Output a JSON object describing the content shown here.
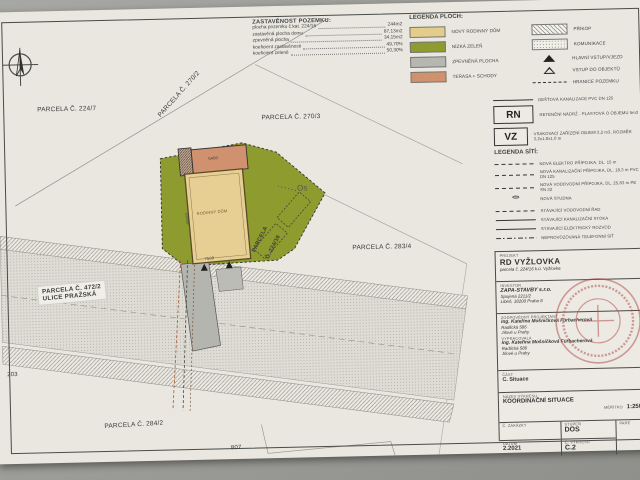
{
  "site_stats": {
    "title": "ZASTAVĚNOST POZEMKU:",
    "rows": [
      {
        "label": "plocha pozemku č.kat. 224/16",
        "value": "244m2"
      },
      {
        "label": "zastavěná plocha domu",
        "value": "87,13m2"
      },
      {
        "label": "zpevněná plocha",
        "value": "34,15m2"
      },
      {
        "label": "koeficient zastavěnosti",
        "value": "49,70%"
      },
      {
        "label": "koeficient zeleně",
        "value": "50,30%"
      }
    ]
  },
  "legend_ploch": {
    "title": "LEGENDA PLOCH:",
    "color_items": [
      {
        "label": "NOVÝ RODINNÝ DŮM",
        "color": "#e4cd8b"
      },
      {
        "label": "NÍZKÁ ZELEŇ",
        "color": "#8d9b2f"
      },
      {
        "label": "ZPEVNĚNÁ PLOCHA",
        "color": "#b7b7b2"
      },
      {
        "label": "TERASA + SCHODY",
        "color": "#d0916f"
      }
    ],
    "pattern_items": [
      {
        "label": "PŘÍKOP"
      },
      {
        "label": "KOMUNIKACE"
      },
      {
        "label": "HLAVNÍ VSTUP/VJEZD"
      },
      {
        "label": "VSTUP DO OBJEKTŮ"
      },
      {
        "label": "HRANICE POZEMKU"
      }
    ]
  },
  "legend_site": {
    "rain_label": "DEŠŤOVÁ KANALIZACE PVC DN 125",
    "rn_code": "RN",
    "rn_label": "RETENČNÍ NÁDRŽ - PLASTOVÁ O OBJEMU 5m3",
    "vz_code": "VZ",
    "vz_label": "VSAKOVACÍ ZAŘÍZENÍ OBJEM 3,2 m3, ROZMĚR 3,2x1,8x1,0 m",
    "title": "LEGENDA SÍTÍ:",
    "items": [
      {
        "label": "NOVÁ ELEKTRO PŘÍPOJKA, DL. 15 m"
      },
      {
        "label": "NOVÁ KANALIZAČNÍ PŘÍPOJKA, DL. 18,3 m PVC DN 125"
      },
      {
        "label": "NOVÁ VODOVODNÍ PŘÍPOJKA, DL. 25,83 m PE SN 32"
      },
      {
        "label": "NOVÁ STUDNA"
      },
      {
        "label": "STÁVAJÍCÍ VODOVODNÍ ŘAD"
      },
      {
        "label": "STÁVAJÍCÍ KANALIZAČNÍ STOKA"
      },
      {
        "label": "STÁVAJÍCÍ ELEKTRICKÝ ROZVOD"
      },
      {
        "label": "NEPROVOZOVANÁ TELEFONNÍ SÍŤ"
      }
    ]
  },
  "title_block": {
    "projekt_label": "PROJEKT",
    "projekt": "RD VYŽLOVKA",
    "projekt_sub": "parcela č. 224/16 k.ú. Vyžlovka",
    "investor_label": "INVESTOR",
    "investor": "ZAPA-STAVBY s.r.o.",
    "investor_addr1": "Spojená 2211/2",
    "investor_addr2": "Libeň, 18200 Praha 8",
    "projektant_label": "ZODPOVĚDNÝ PROJEKTANT",
    "projektant": "Ing. Kateřina Mošničková Fürbacherová",
    "projektant_addr1": "Radlická 586",
    "projektant_addr2": "Jílové u Prahy",
    "vypracovala_label": "VYPRACOVALA",
    "vypracovala": "Ing. Kateřina Mošničková Fürbacherová",
    "vypracovala_addr1": "Radlická 586",
    "vypracovala_addr2": "Jílové u Prahy",
    "cast_label": "ČÁST",
    "cast": "C. Situace",
    "nazev_label": "NÁZEV VÝKRESU",
    "nazev": "KOORDINAČNÍ SITUACE",
    "meritko_label": "MĚŘÍTKO",
    "meritko": "1:250",
    "zakazka_label": "Č. ZAKÁZKY",
    "stupen_label": "STUPEŇ",
    "stupen": "DOS",
    "pare_label": "PARÉ",
    "datum_label": "DATUM",
    "datum": "2.2021",
    "vykres_label": "Č. VÝKRESU",
    "vykres": "C.2"
  },
  "map": {
    "parcel_224_7": "PARCELA Č. 224/7",
    "parcel_270_2": "PARCELA Č. 270/2",
    "parcel_270_3": "PARCELA Č. 270/3",
    "parcel_283_4": "PARCELA Č. 283/4",
    "parcel_284_2": "PARCELA Č. 284/2",
    "parcel_472_2": "PARCELA Č. 472/2",
    "street": "ULICE PRAŽSKÁ",
    "parcel_224_16_line1": "PARCELA",
    "parcel_224_16_line2": "Č. 224/16",
    "house_label": "RODINNÝ DŮM",
    "num_left": "203",
    "num_bottom": "807",
    "os_label": "Os",
    "dim_width": "7500",
    "dim_terrace": "5400",
    "dim_depth": "11500"
  }
}
